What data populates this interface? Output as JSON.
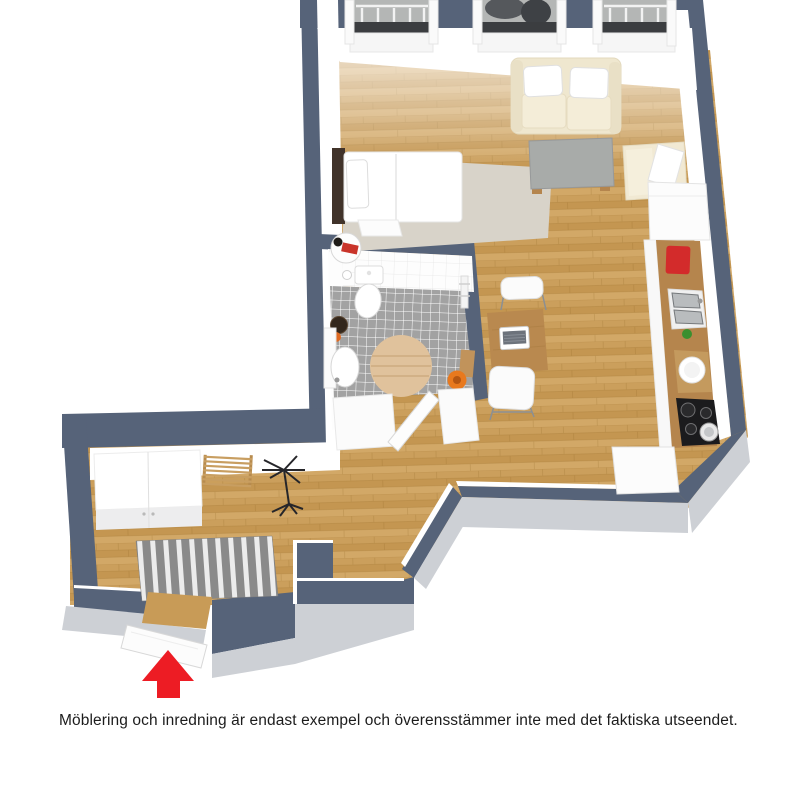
{
  "caption": {
    "text": "Möblering och inredning är endast exempel och överensstämmer inte med det faktiska utseendet."
  },
  "entrance": {
    "marker_icon": "arrow-up",
    "color": "#ed1c24"
  },
  "floorplan": {
    "rooms": [
      "living-room",
      "sleeping-area",
      "bathroom",
      "kitchen-row",
      "hallway",
      "entrance"
    ],
    "windows": 3
  },
  "colors": {
    "wall": "#566379",
    "wall_face": "#ffffff",
    "wall_outer_face": "#cdd0d5",
    "floor_wood": "#cb9f5c",
    "floor_wood_dark": "#bf9049",
    "floor_wood_light": "#d7af70",
    "tile_floor": "#a2a2a2",
    "tile_grout": "#ffffff",
    "bath_wall": "#fdfdfd",
    "area_rug": "#d8d3c9",
    "rug_stripe_dark": "#8a8a8a",
    "rug_stripe_light": "#ececec",
    "sofa": "#efe7cf",
    "seat_cushion": "#f4edd8",
    "pillow": "#ffffff",
    "coffee_table": "#a8aba9",
    "armchair": "#f1e9d3",
    "bed_linen": "#ffffff",
    "bed_headboard": "#41332a",
    "dining_table": "#b9894f",
    "chair": "#fbfbfb",
    "counter_wood": "#b5854d",
    "cabinet": "#fcfcfc",
    "canister_red": "#d32b2b",
    "cooktop": "#1b1b1d",
    "sink_steel": "#b9bcbe",
    "bottle_green": "#3a8f2f",
    "bath_rug": "#e0c29c",
    "bucket_orange": "#e8791e",
    "bowl_dark": "#33271c",
    "window_recess": "#b4b6b5",
    "window_sill_dark": "#3b3d40",
    "arrow_red": "#ed1c24"
  }
}
